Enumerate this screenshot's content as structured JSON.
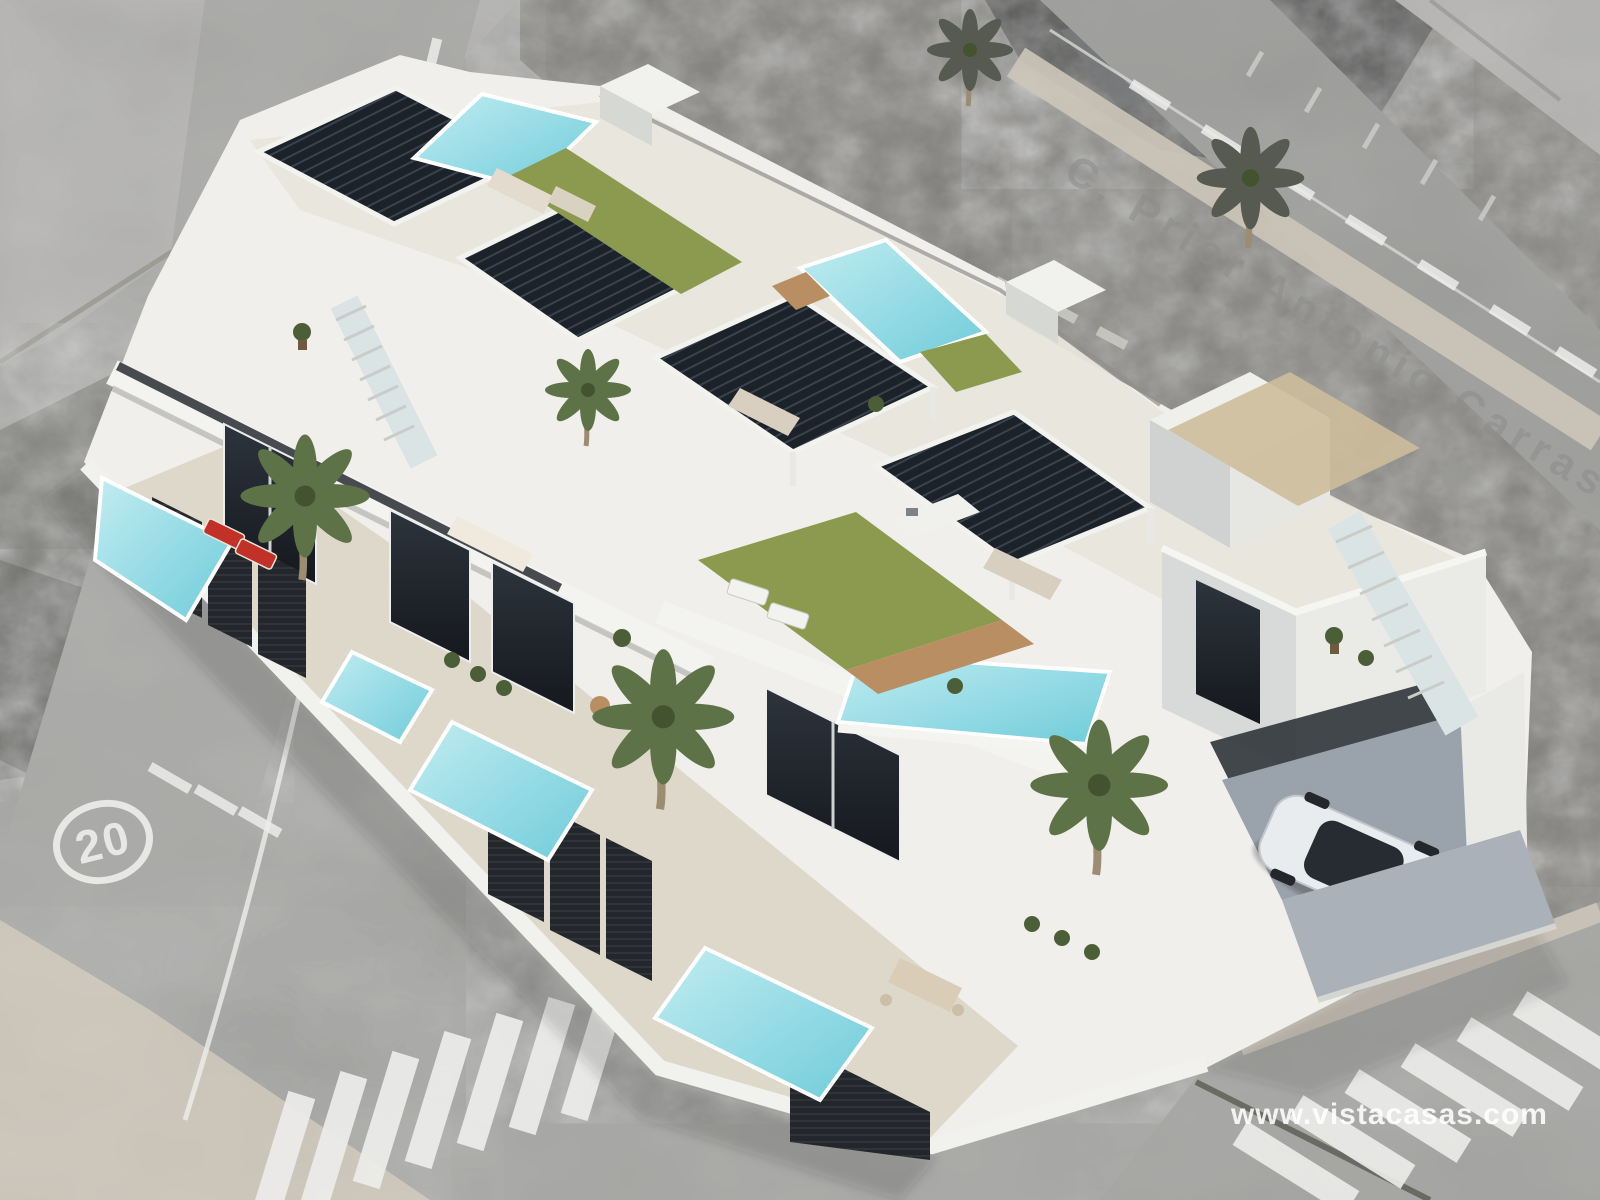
{
  "watermark": {
    "text": "www.vistacasas.com"
  },
  "background_map": {
    "street_label": "C. Prior Antonio Carrasco"
  },
  "road_markings": {
    "speed_limit_circle": "20"
  },
  "scene": {
    "type": "3d-architectural-render-of-townhouses-over-grayscale-aerial-photo",
    "building_units_visible": 4,
    "rooftop_pergolas": 4,
    "rooftop_pools": 3,
    "front_yard_pools": 4,
    "rooftop_lawns": 3,
    "foreground_palm_trees": 3,
    "background_palm_trees": 2,
    "cars": 1,
    "crosswalks": 2,
    "exterior_staircases": 2
  },
  "colors": {
    "building_white": "#f0efeb",
    "building_shade": "#d6d8d4",
    "building_dark_side": "#c7cac8",
    "pergola_dark": "#1c222a",
    "pergola_slat": "#39424d",
    "pool_water_light": "#c2ecf1",
    "pool_water_deep": "#6fccda",
    "lawn_green": "#8b9a4f",
    "deck_wood": "#b98e62",
    "fence_black": "#23262b",
    "glass_dark": "#22272e",
    "road_gray": "#a7a7a5",
    "sidewalk_beige": "#cdc6ba",
    "scrub_gray": "#82817c",
    "marking_white": "#ededeb",
    "car_white": "#e9ecee",
    "lounger_red": "#c23127",
    "palm_green": "#5d7247",
    "palm_gray": "#565a50",
    "yard_floor": "#ded8cb",
    "roof_floor": "#e8e5dc",
    "watermark_white": "#ffffff"
  }
}
